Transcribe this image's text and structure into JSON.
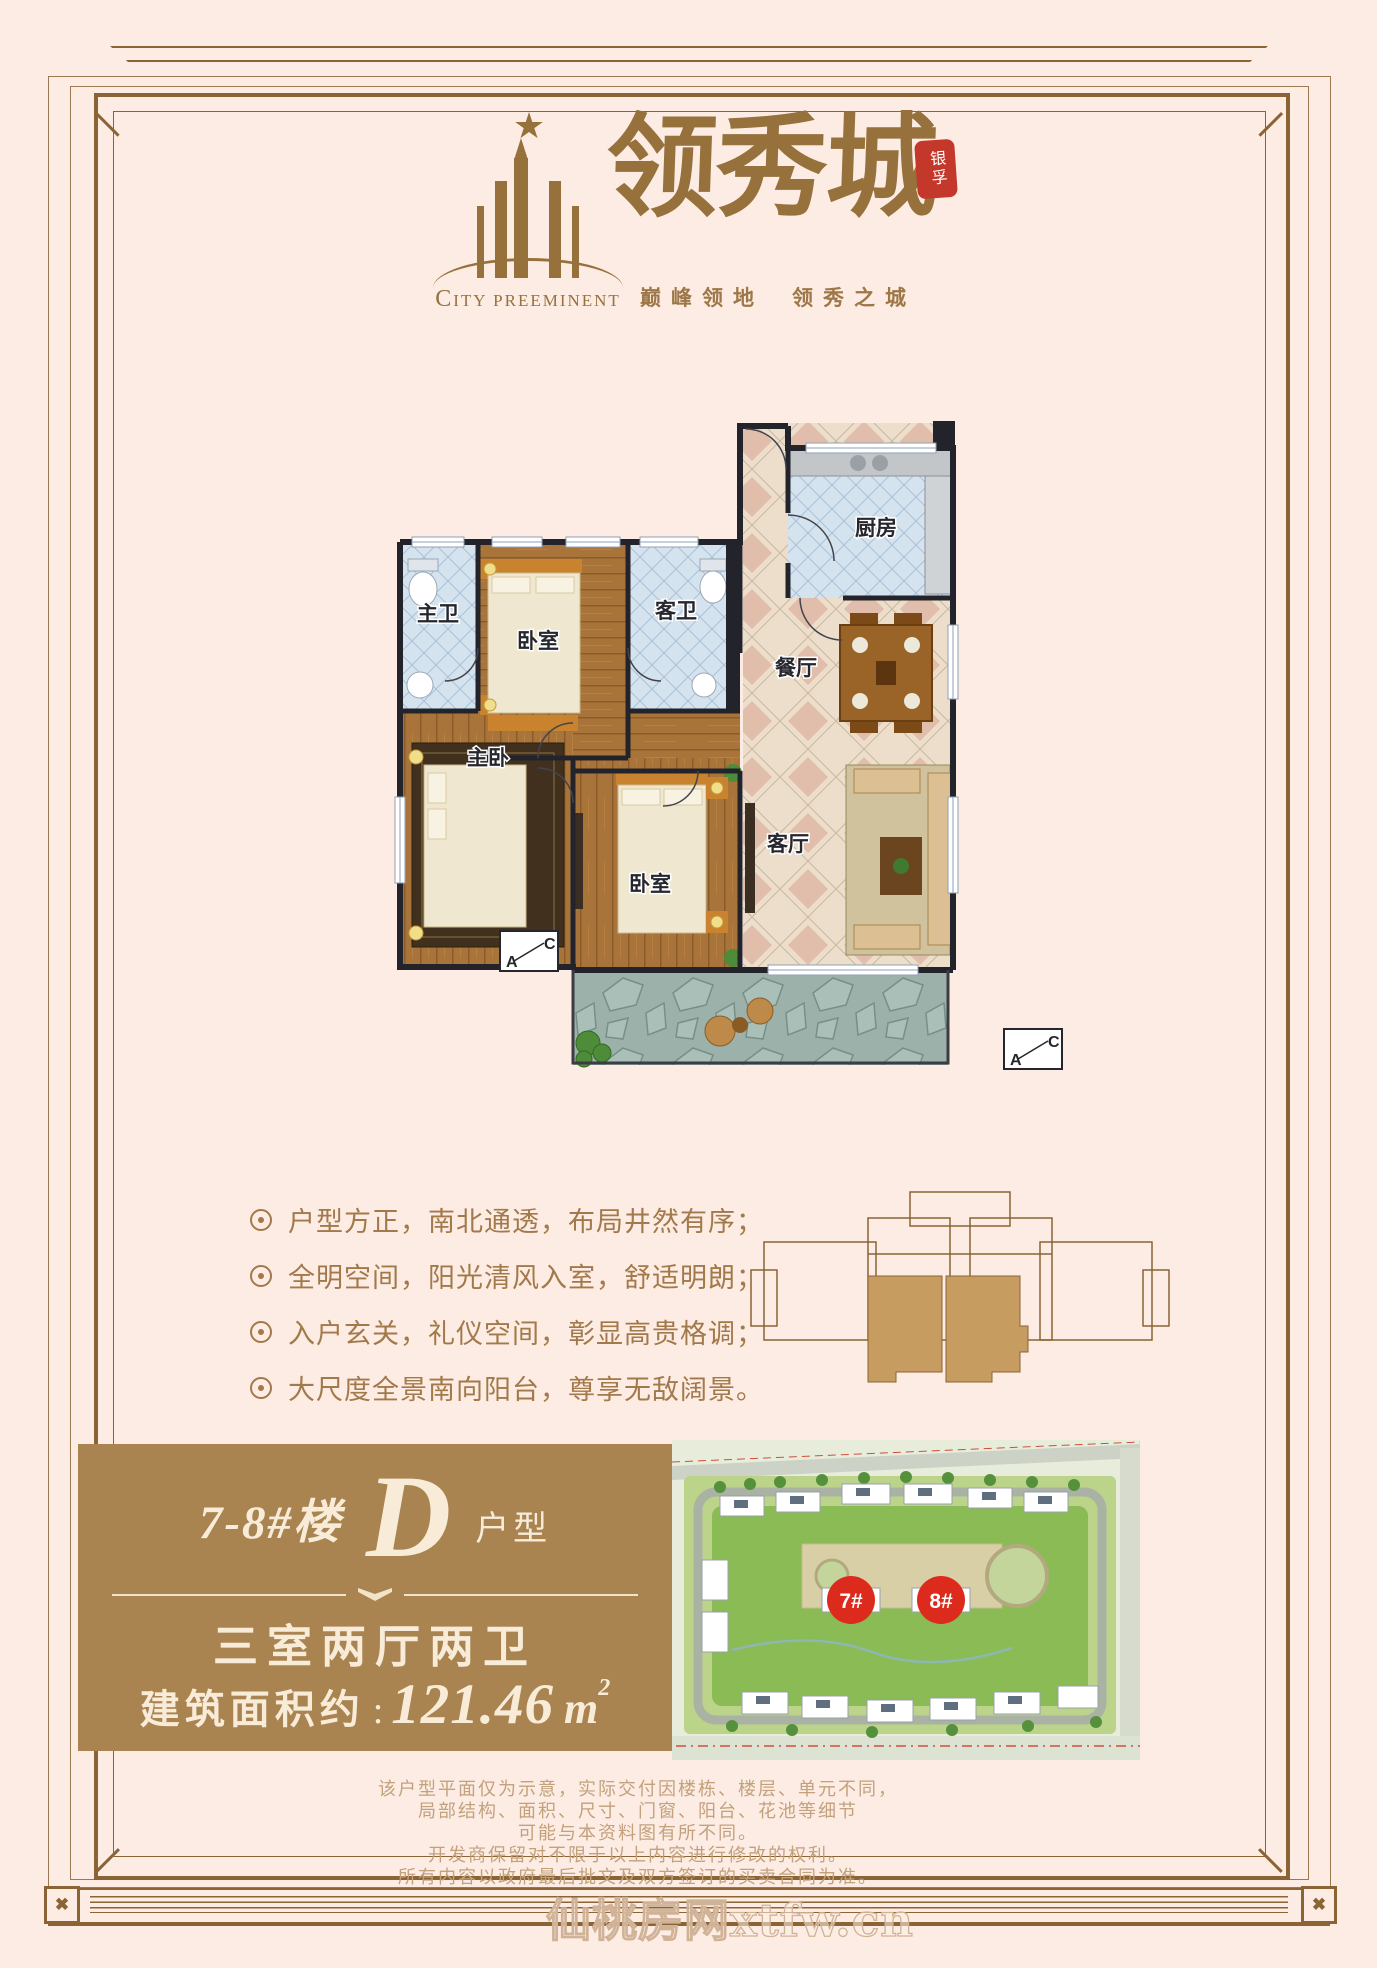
{
  "brand": {
    "logo_zh": "领秀城",
    "logo_en": "CITY PREEMINENT",
    "seal": "银孚",
    "slogan_left": "巅峰领地",
    "slogan_right": "领秀之城"
  },
  "plan": {
    "rooms": [
      {
        "label": "主卫"
      },
      {
        "label": "卧室"
      },
      {
        "label": "客卫"
      },
      {
        "label": "厨房"
      },
      {
        "label": "餐厅"
      },
      {
        "label": "主卧"
      },
      {
        "label": "卧室"
      },
      {
        "label": "客厅"
      }
    ],
    "marker_a": "A",
    "marker_c": "C"
  },
  "features": {
    "items": [
      {
        "text": "户型方正，南北通透，布局井然有序；"
      },
      {
        "text": "全明空间，阳光清风入室，舒适明朗；"
      },
      {
        "text": "入户玄关，礼仪空间，彰显高贵格调；"
      },
      {
        "text": "大尺度全景南向阳台，尊享无敌阔景。"
      }
    ]
  },
  "unit": {
    "building": "7-8#楼",
    "type_letter": "D",
    "type_suffix": "户型",
    "layout": "三室两厅两卫",
    "area_label": "建筑面积约",
    "area_sep": ":",
    "area_value": "121.46",
    "area_unit": "m",
    "area_exp": "2"
  },
  "site": {
    "markers": [
      {
        "label": "7#"
      },
      {
        "label": "8#"
      }
    ]
  },
  "disclaimer": {
    "lines": [
      {
        "text": "该户型平面仅为示意，实际交付因楼栋、楼层、单元不同，"
      },
      {
        "text": "局部结构、面积、尺寸、门窗、阳台、花池等细节"
      },
      {
        "text": "可能与本资料图有所不同。"
      },
      {
        "text": "开发商保留对不限于以上内容进行修改的权利。"
      },
      {
        "text": "所有内容以政府最后批文及双方签订的买卖合同为准。"
      }
    ]
  },
  "watermark": "仙桃房网xtfw.cn",
  "colors": {
    "background": "#fdece3",
    "frame_gold": "#8a6434",
    "brand_gold": "#96713c",
    "text_gold": "#a2794a",
    "panel_brown": "#a98350",
    "panel_text": "#f8ecd9",
    "seal_red": "#c4372b",
    "marker_red": "#dc2a1c"
  }
}
